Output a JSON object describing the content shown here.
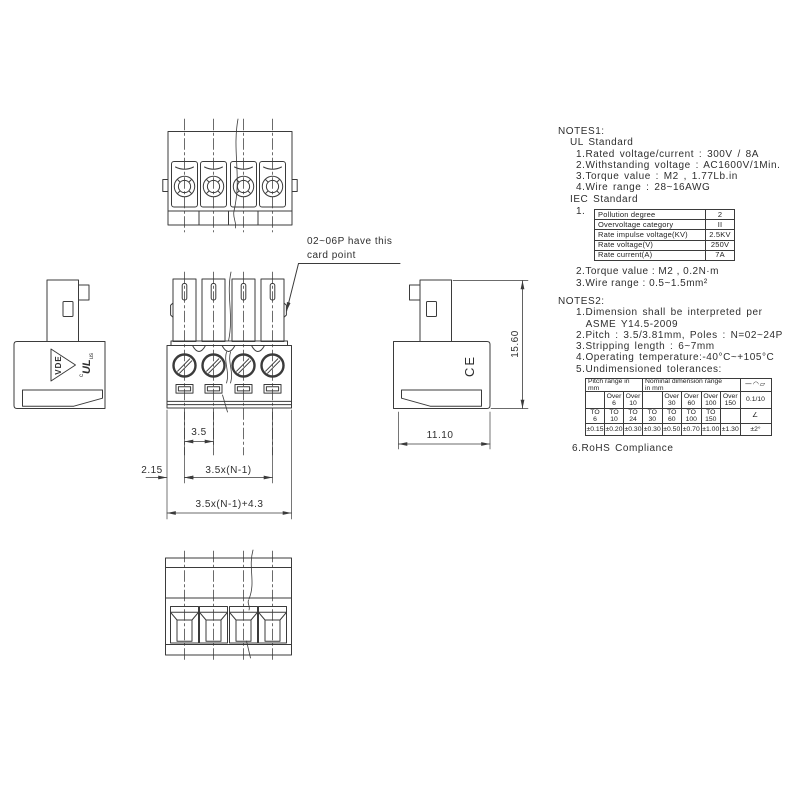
{
  "drawing": {
    "annotation_card_point": "02~06P have this\ncard point",
    "dim_pitch": "3.5",
    "dim_pitch_span": "3.5x(N-1)",
    "dim_left_margin": "2.15",
    "dim_total_width": "3.5x(N-1)+4.3",
    "dim_depth": "11.10",
    "dim_height": "15.60",
    "logo_vde": "VDE",
    "logo_ul_c": "c",
    "logo_ul": "UL",
    "logo_ul_us": "us",
    "logo_ce": "CE"
  },
  "notes1": {
    "title": "NOTES1:",
    "ul_heading": "UL Standard",
    "ul_items": [
      "1.Rated voltage/current : 300V / 8A",
      "2.Withstanding voltage : AC1600V/1Min.",
      "3.Torque value : M2 , 1.77Lb.in",
      "4.Wire range : 28~16AWG"
    ],
    "iec_heading": "IEC Standard",
    "iec_item1_label": "1.",
    "iec_table": {
      "rows": [
        {
          "label": "Pollution degree",
          "value": "2"
        },
        {
          "label": "Overvoltage category",
          "value": "II"
        },
        {
          "label": "Rate impulse voltage(KV)",
          "value": "2.5KV"
        },
        {
          "label": "Rate voltage(V)",
          "value": "250V"
        },
        {
          "label": "Rate current(A)",
          "value": "7A"
        }
      ]
    },
    "iec_items": [
      "2.Torque value : M2 , 0.2N·m",
      "3.Wire range : 0.5~1.5mm²"
    ]
  },
  "notes2": {
    "title": "NOTES2:",
    "items": [
      "1.Dimension shall be interpreted per\n  ASME Y14.5-2009",
      "2.Pitch : 3.5/3.81mm, Poles : N=02~24P",
      "3.Stripping length : 6~7mm",
      "4.Operating temperature:-40°C~+105°C",
      "5.Undimensioned tolerances:"
    ],
    "item_rohs": "6.RoHS Compliance",
    "tolerance_table": {
      "header_pitch": "Pitch range in\nmm",
      "header_nominal": "Nominal dimension range\nin mm",
      "header_symbols": "—◠▱",
      "over_cells": [
        "",
        "Over\n6",
        "Over\n10",
        "",
        "Over\n30",
        "Over\n60",
        "Over\n100",
        "Over\n150"
      ],
      "straightness": "0.1/10",
      "to_cells": [
        "TO\n6",
        "TO\n10",
        "TO\n24",
        "TO\n30",
        "TO\n60",
        "TO\n100",
        "TO\n150",
        ""
      ],
      "angle_symbol": "∠",
      "tolerances": [
        "±0.15",
        "±0.20",
        "±0.30",
        "±0.30",
        "±0.50",
        "±0.70",
        "±1.00",
        "±1.30"
      ],
      "angle_tolerance": "±2°"
    }
  },
  "colors": {
    "line": "#3b3b3b",
    "text": "#2e2e2e"
  }
}
